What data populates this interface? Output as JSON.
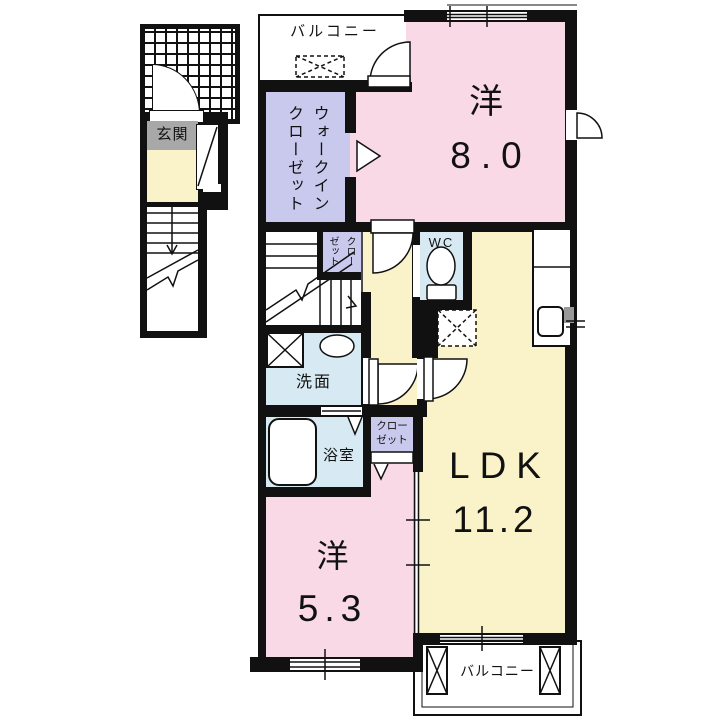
{
  "plan": {
    "title": "2F apartment floor plan",
    "entrance_unit": {
      "genkan": "玄関"
    },
    "rooms": {
      "balcony_top": "バルコニー",
      "walk_in_closet": "ウォークイン\nクローゼット",
      "western_8": {
        "name": "洋",
        "size": "8.0"
      },
      "closet_mid": "クロー\nゼット",
      "wc": "WC",
      "washroom": "洗面",
      "bathroom": "浴室",
      "closet_low": "クロー\nゼット",
      "ldk": {
        "name": "LDK",
        "size": "11.2"
      },
      "western_5": {
        "name": "洋",
        "size": "5.3"
      },
      "balcony_bottom": "バルコニー"
    },
    "colors": {
      "room_pink": "#f9d9e6",
      "room_yellow": "#faf3c9",
      "room_purple": "#c9c9ed",
      "room_blue": "#d7eaf3",
      "label_gray": "#a8a8a8",
      "wall": "#111111"
    }
  }
}
